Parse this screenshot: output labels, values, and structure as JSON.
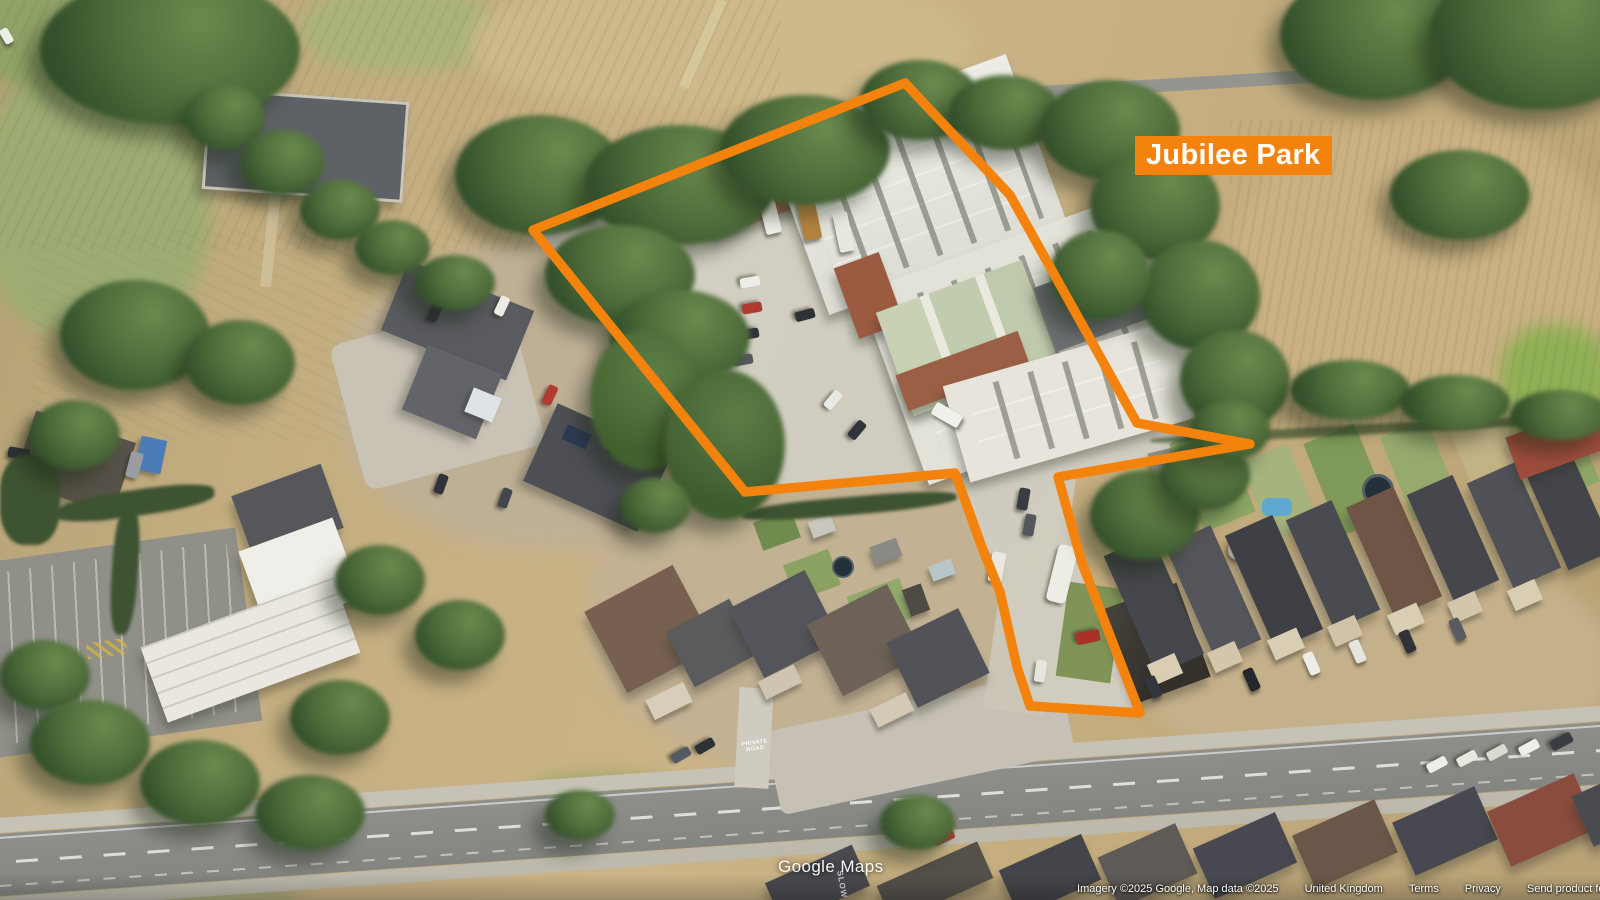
{
  "map_overlay": {
    "site_label": "Jubilee Park",
    "accent_color": "#F4830D",
    "polygon_points": "533,230 905,83 1010,195 1137,423 1250,444 1058,477 1082,563 1140,713 1030,706 1017,667 1000,592 983,550 962,492 955,473 745,492"
  },
  "watermark": {
    "text": "Google Maps"
  },
  "attribution": {
    "imagery": "Imagery ©2025 Google, Map data ©2025",
    "region": "United Kingdom",
    "terms": "Terms",
    "privacy": "Privacy",
    "feedback": "Send product feedback"
  },
  "road_markings": {
    "private_road": "PRIVATE\nROAD",
    "slow": "SLOW"
  }
}
